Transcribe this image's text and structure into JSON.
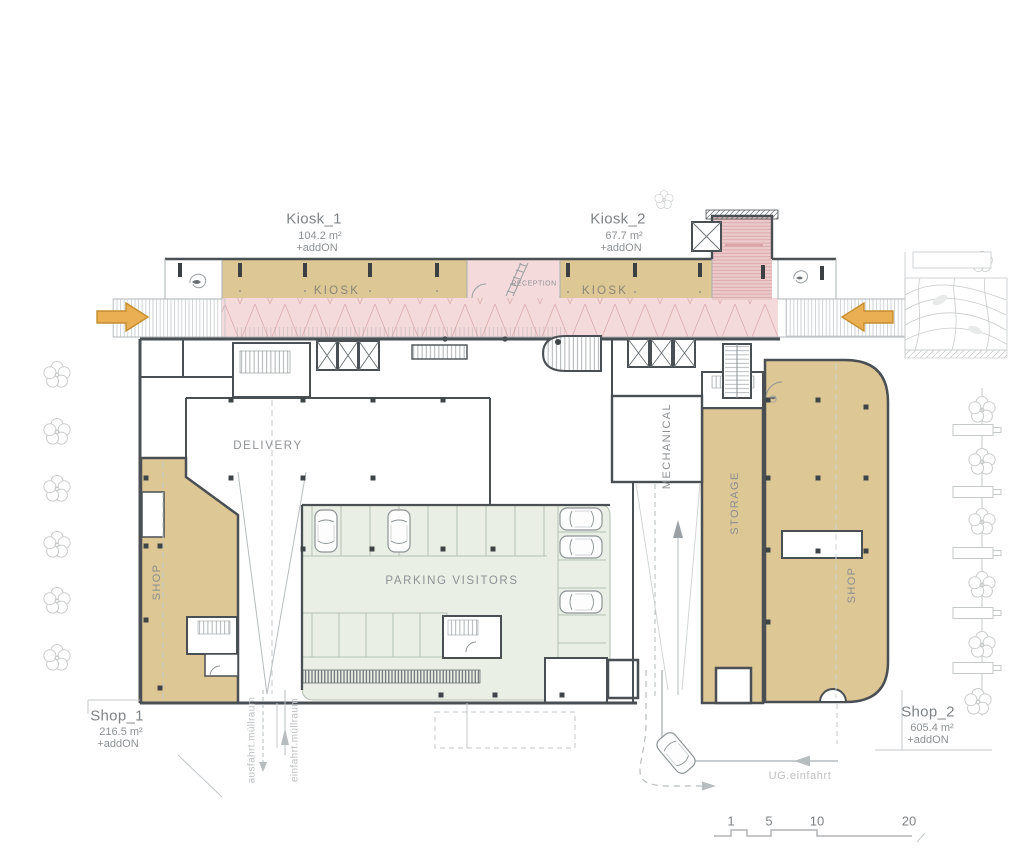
{
  "areas": {
    "kiosk1": {
      "name": "Kiosk_1",
      "area": "104.2 m²",
      "addon": "+addON"
    },
    "kiosk2": {
      "name": "Kiosk_2",
      "area": "67.7 m²",
      "addon": "+addON"
    },
    "shop1": {
      "name": "Shop_1",
      "area": "216.5 m²",
      "addon": "+addON"
    },
    "shop2": {
      "name": "Shop_2",
      "area": "605.4 m²",
      "addon": "+addON"
    }
  },
  "rooms": {
    "kiosk_left": "KIOSK",
    "reception": "RECEPTION",
    "kiosk_right": "KIOSK",
    "delivery": "DELIVERY",
    "parking_visitors": "PARKING VISITORS",
    "mechanical": "MECHANICAL",
    "storage": "STORAGE",
    "shop_left": "SHOP",
    "shop_right": "SHOP"
  },
  "annotations": {
    "ausfahrt_muellraum": "ausfahrt.müllraum",
    "einfahrt_muellraum": "einfahrt.müllraum",
    "ug_einfahrt": "UG.einfahrt"
  },
  "scale_bar": {
    "ticks": [
      "1",
      "5",
      "10",
      "20"
    ]
  },
  "colors": {
    "retail_fill": "#dcc795",
    "arcade_fill": "#f4dadb",
    "parking_fill": "#e9efe5",
    "wall": "#4a4f53",
    "entry_arrow": "#eaaf52"
  }
}
